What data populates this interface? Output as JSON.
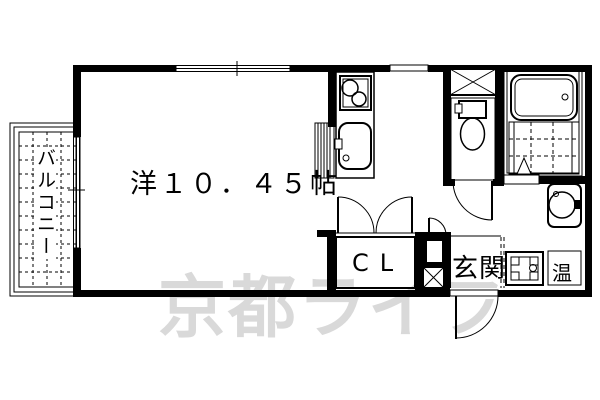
{
  "floor_plan": {
    "room": {
      "label": "洋１０．４５帖"
    },
    "balcony": {
      "label": "バルコニー"
    },
    "closet": {
      "label": "CL"
    },
    "entrance": {
      "label": "玄関"
    },
    "water_heater": {
      "label": "温"
    },
    "watermark": {
      "text": "京都ライフ",
      "color": "#d9d9d9"
    },
    "colors": {
      "line": "#000000",
      "background": "#ffffff",
      "watermark": "#d9d9d9"
    }
  }
}
